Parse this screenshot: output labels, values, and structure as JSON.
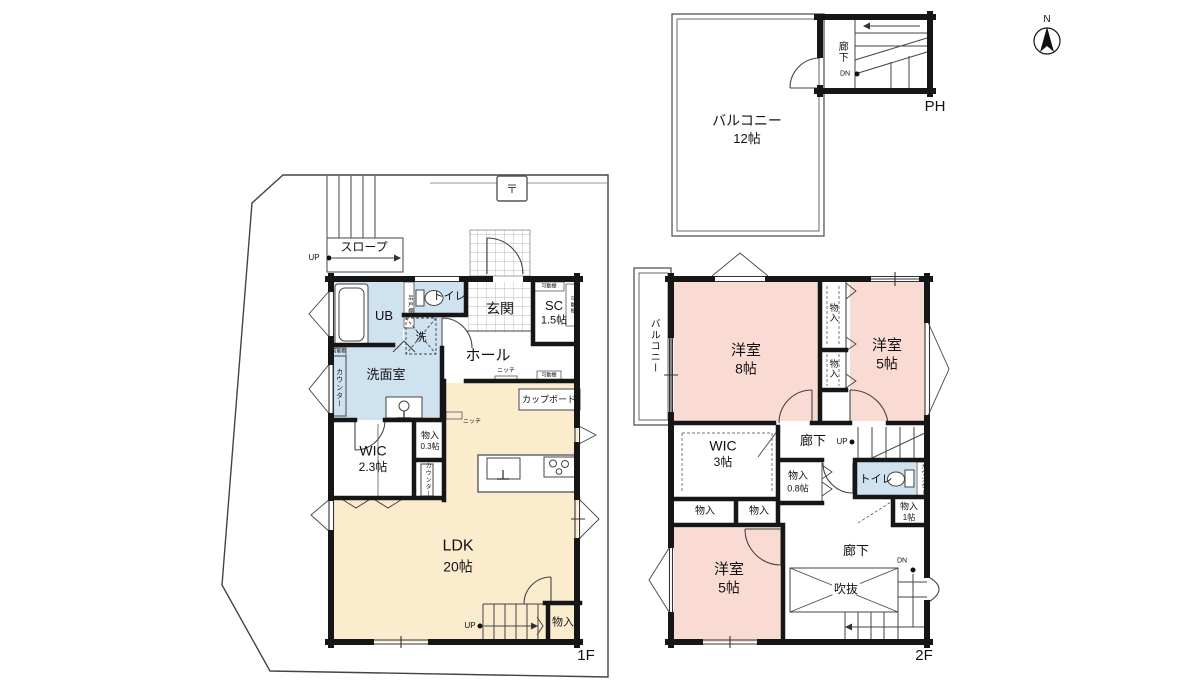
{
  "colors": {
    "wall": "#161616",
    "thin_line": "#555555",
    "room_pink": "#fadbd3",
    "room_cream": "#fcecce",
    "room_blue": "#cfe2f0"
  },
  "compass": {
    "north": "N"
  },
  "ph": {
    "balcony": "バルコニー",
    "balcony_size": "12帖",
    "hall": "廊下",
    "dn": "DN",
    "label": "PH"
  },
  "f1": {
    "floor": "1F",
    "slope": "スロープ",
    "up_ramp": "UP",
    "post": "〒",
    "ub": "UB",
    "hanging_shelf": "吊戸棚",
    "toilet": "トイレ",
    "entrance": "玄関",
    "sc": "SC",
    "sc_size": "1.5帖",
    "shelf_sc_top": "可動棚",
    "shelf_sc_side": "可動棚",
    "hall": "ホール",
    "washer": "洗",
    "washroom": "洗面室",
    "counter_left": "カウンター",
    "shelf_counter": "可動棚",
    "niche1": "ニッチ",
    "shelf_hall": "可動棚",
    "cupboard": "カップボード",
    "niche2": "ニッチ",
    "wic": "WIC",
    "wic_size": "2.3帖",
    "storage_small": "物入",
    "storage_small_size": "0.3帖",
    "counter_right": "カウンター",
    "ldk": "LDK",
    "ldk_size": "20帖",
    "up_stairs": "UP",
    "storage_bottom": "物入"
  },
  "f2": {
    "floor": "2F",
    "balcony": "バルコニー",
    "room8": "洋室",
    "room8_size": "8帖",
    "closet_upper": "物入",
    "closet_lower": "物入",
    "room5a": "洋室",
    "room5a_size": "5帖",
    "wic": "WIC",
    "wic_size": "3帖",
    "hall_mid": "廊下",
    "up": "UP",
    "storage08": "物入",
    "storage08_size": "0.8帖",
    "toilet": "トイレ",
    "counter": "カウンター",
    "closet_b1": "物入",
    "closet_b2": "物入",
    "storage1": "物入",
    "storage1_size": "1帖",
    "room5b": "洋室",
    "room5b_size": "5帖",
    "hall_bottom": "廊下",
    "void": "吹抜",
    "dn": "DN"
  }
}
